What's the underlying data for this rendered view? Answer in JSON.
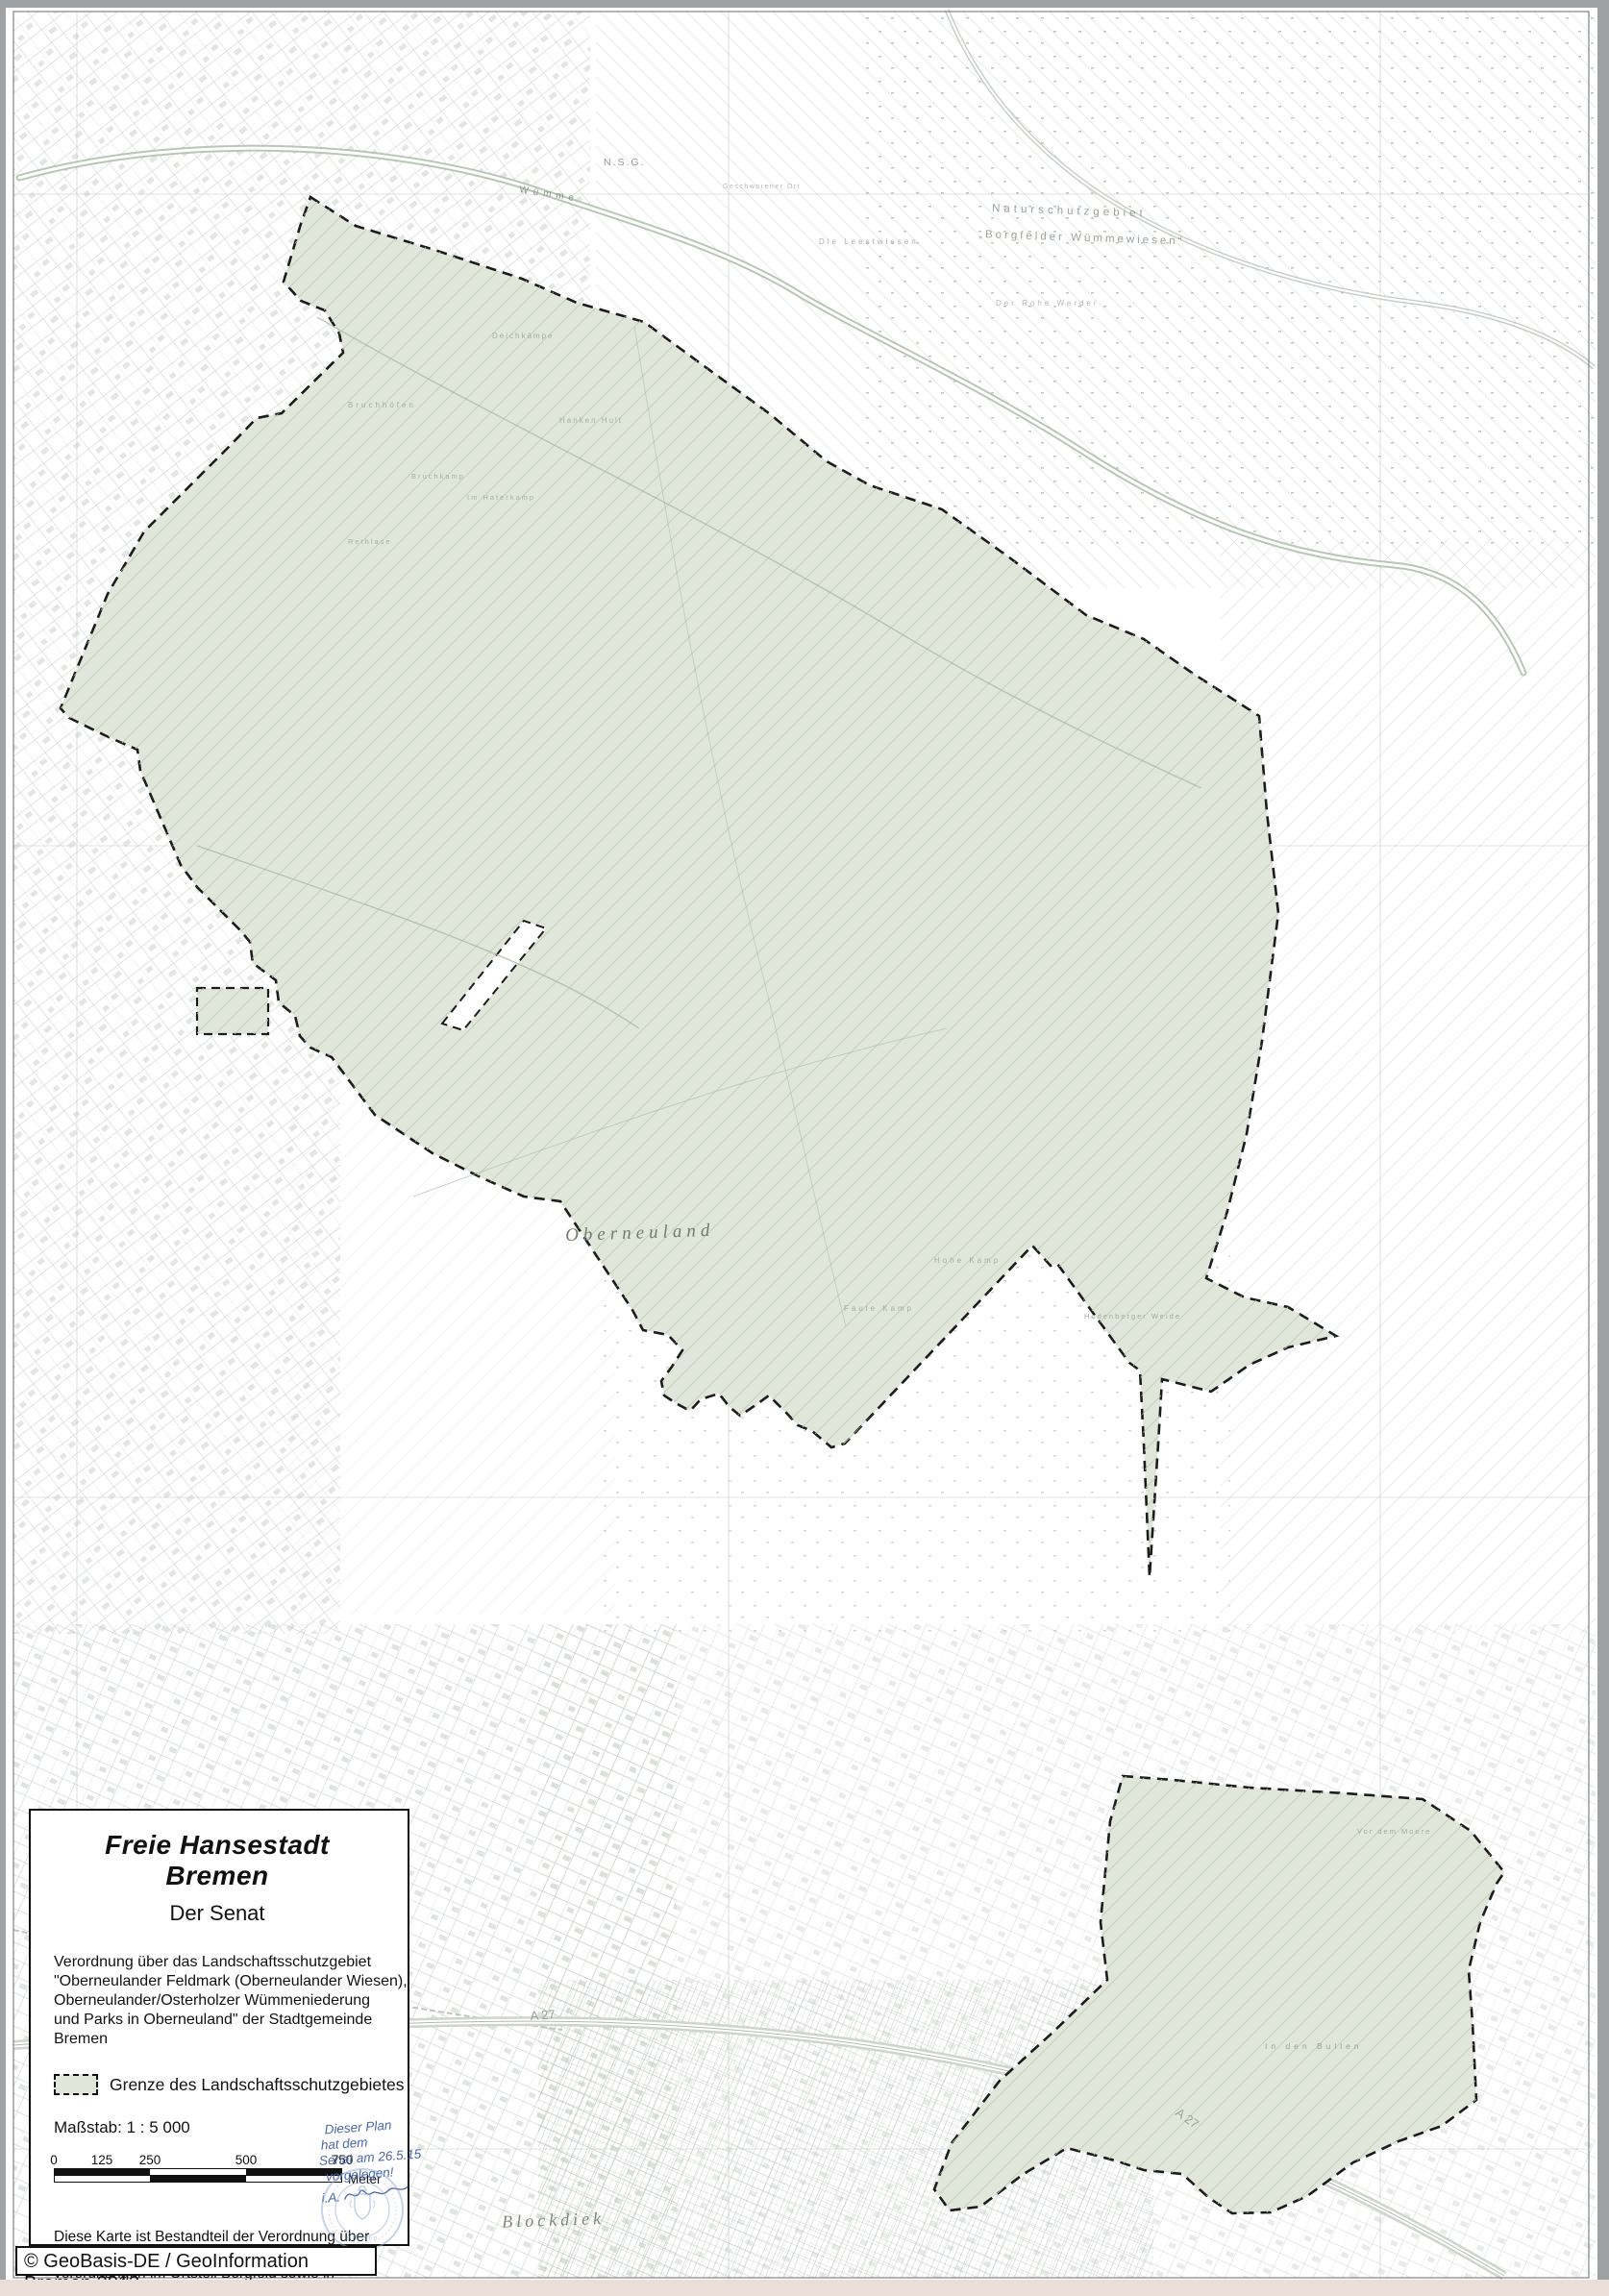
{
  "colors": {
    "protected_fill": "#e0e7da",
    "boundary": "#1c1c1c",
    "ink_blue": "#4a67ab",
    "stamp_blue": "#8fa6cd",
    "map_line": "#c7cdc7"
  },
  "map": {
    "labels": {
      "nsg": "N.S.G.",
      "wumme": "Wümme",
      "nsg_area_line1": "Naturschutzgebiet",
      "nsg_area_line2": "„Borgfelder Wümmewiesen“",
      "geschworener_ort": "Geschworener Ort",
      "leestwiesen": "Die Leestwiesen",
      "rohe_werder": "Der Rohe Werder",
      "deichkaempe": "Deichkämpe",
      "bruchhoefen": "Bruchhöfen",
      "hanken_hult": "Hanken Hult",
      "bruchkamp": "Bruchkamp",
      "haterkamp": "Im Haterkamp",
      "rethlase": "Rethlase",
      "oberneuland": "Oberneuland",
      "hohe_kamp": "Hohe Kamp",
      "faule_kamp": "Faule Kamp",
      "hodenberger_weide": "Hodenberger Weide",
      "vor_dem_moore": "Vor dem Moore",
      "in_den_bullen": "In den Bullen",
      "blockdiek": "Blockdiek",
      "a27_west": "A 27",
      "a27_east": "A 27"
    }
  },
  "legend": {
    "title": "Freie Hansestadt Bremen",
    "subtitle": "Der Senat",
    "ordinance_lines": [
      "Verordnung über das Landschaftsschutzgebiet",
      "\"Oberneulander Feldmark (Oberneulander Wiesen),",
      "Oberneulander/Osterholzer Wümmeniederung",
      "und Parks in Oberneuland\" der Stadtgemeinde Bremen"
    ],
    "area_item_label": "Grenze des Landschaftsschutzgebietes",
    "scale_text": "Maßstab: 1 : 5 000",
    "scale_bar": {
      "ticks": [
        "0",
        "125",
        "250",
        "500",
        "750"
      ],
      "unit": "Meter"
    },
    "note_lines": [
      "Diese Karte ist Bestandteil der Verordnung über",
      "Naturschutz- und Landschaftsschutzgebiets-",
      "verordnungen im Ortsteil Borgfeld sowie in",
      "den Stadtteilen Horn-Lehe, Oberneuland und",
      "Osterholz der Stadtgemeinde Bremen",
      "(Artikel 4) vom 19. Mai 2015",
      "(Az.: 631-11-01/22)"
    ]
  },
  "annotation": {
    "handwriting_lines": [
      "Dieser Plan",
      "hat dem",
      "Senat am 26.5.15",
      "vorgelegen!",
      "i.A."
    ],
    "stamp_bottom_text": "Bremen"
  },
  "footer": {
    "copyright": "© GeoBasis-DE / GeoInformation Bremen 2013"
  }
}
